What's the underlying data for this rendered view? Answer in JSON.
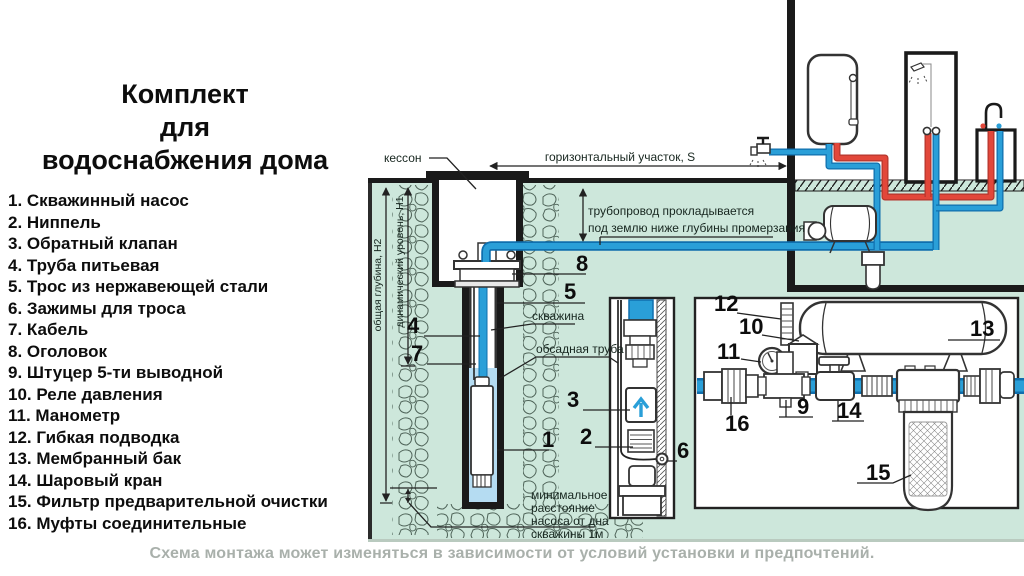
{
  "colors": {
    "ground_green": "#cde7db",
    "stone_line": "#4f6459",
    "well_water": "#b5dcf2",
    "pipe_blue": "#2a9fd8",
    "pipe_blue_dark": "#0f6fae",
    "pipe_red": "#e2473a",
    "line_black": "#1a1a1a",
    "caption_gray": "#a9b0ab"
  },
  "left_panel": {
    "title_lines": [
      "Комплект",
      "для",
      "водоснабжения дома"
    ],
    "items": [
      "1. Скважинный насос",
      "2. Ниппель",
      "3. Обратный клапан",
      "4. Труба питьевая",
      "5. Трос из нержавеющей стали",
      "6. Зажимы для троса",
      "7. Кабель",
      "8. Оголовок",
      "9. Штуцер 5-ти выводной",
      "10. Реле давления",
      "11. Манометр",
      "12. Гибкая подводка",
      "13. Мембранный бак",
      "14. Шаровый кран",
      "15. Фильтр предварительной очистки",
      "16. Муфты соединительные"
    ]
  },
  "diagram": {
    "labels": {
      "kesson": "кессон",
      "horizontal_section": "горизонтальный участок, S",
      "pipeline_note_line1": "трубопровод прокладывается",
      "pipeline_note_line2": "под землю ниже глубины промерзания",
      "well": "скважина",
      "casing_pipe": "обсадная труба",
      "total_depth": "общая глубина, Н2",
      "dynamic_level": "динамический уровень, Н1",
      "min_distance_line1": "минимальное",
      "min_distance_line2": "расстояние",
      "min_distance_line3": "насоса от дна",
      "min_distance_line4": "скважины 1м"
    },
    "callouts": {
      "c1": "1",
      "c2": "2",
      "c3": "3",
      "c4": "4",
      "c5": "5",
      "c6": "6",
      "c7": "7",
      "c8": "8",
      "c9": "9",
      "c10": "10",
      "c11": "11",
      "c12": "12",
      "c13": "13",
      "c14": "14",
      "c15": "15",
      "c16": "16"
    }
  },
  "footer": {
    "note": "Схема монтажа может изменяться в зависимости от условий установки и предпочтений."
  }
}
